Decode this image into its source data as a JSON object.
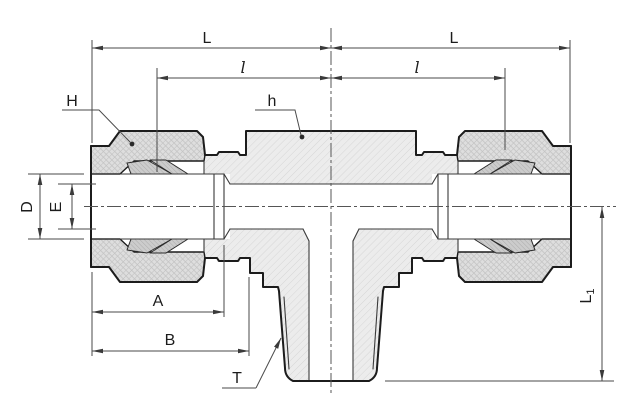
{
  "drawing": {
    "labels": {
      "L_left": "L",
      "L_right": "L",
      "l_left": "l",
      "l_right": "l",
      "H": "H",
      "h": "h",
      "D": "D",
      "E": "E",
      "A": "A",
      "B": "B",
      "T": "T",
      "L1_main": "L",
      "L1_sub": "1"
    },
    "colors": {
      "outline": "#1c1c1c",
      "dimension_lines": "#4a4a4a",
      "body_fill": "#ececec",
      "nut_fill": "#dedede",
      "ferrule_fill": "#cccccc",
      "background": "#ffffff"
    }
  }
}
